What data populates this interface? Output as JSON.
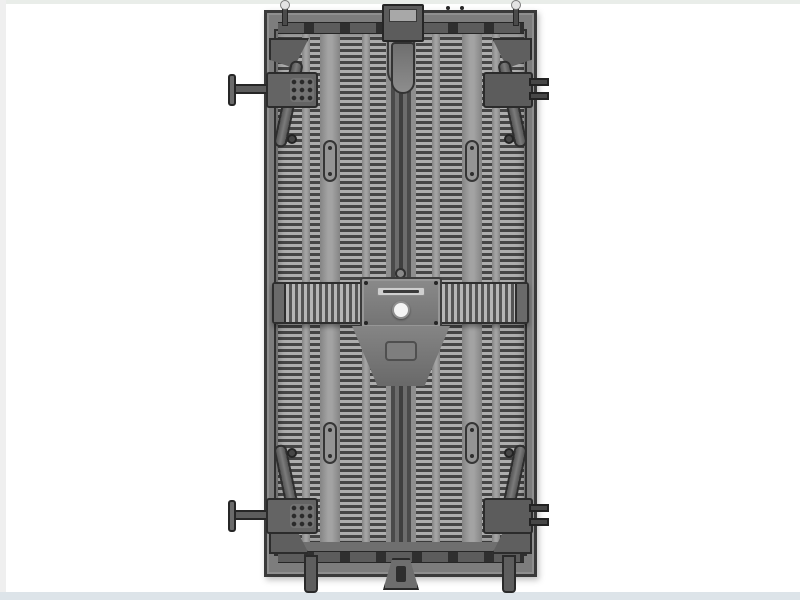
{
  "scene": {
    "description": "product photo of the rear side of an LED display cabinet on a white background",
    "background_color": "#ffffff",
    "page_edge_top_color": "#e9ede9",
    "page_edge_left_color": "#efefef",
    "floor_strip_color": "#dde4e9"
  },
  "cabinet": {
    "view": "rear",
    "frame_color": "#3a3a3a",
    "body_color": "#7d7d7d",
    "heatsink": {
      "fin_light_color": "#aeaeae",
      "fin_dark_color": "#454545",
      "rail_color": "#a3a3a3",
      "fin_columns": 4
    },
    "center_spine_color": "#4a4a4a",
    "center_bar": {
      "rib_light_color": "#b6b6b6",
      "rib_dark_color": "#555555",
      "plate_color": "#7a7a7a",
      "nameplate_color": "#cfcfcf",
      "nameplate_text": "",
      "round_button_color": "#f4f4f4"
    },
    "hardware": {
      "color": "#5c5c5c",
      "corner_latches": 4,
      "left_t_handles": 2,
      "right_lock_blocks": 2,
      "handle_slots": 4,
      "top_guide_pins": 2,
      "bottom_feet": 3
    }
  }
}
